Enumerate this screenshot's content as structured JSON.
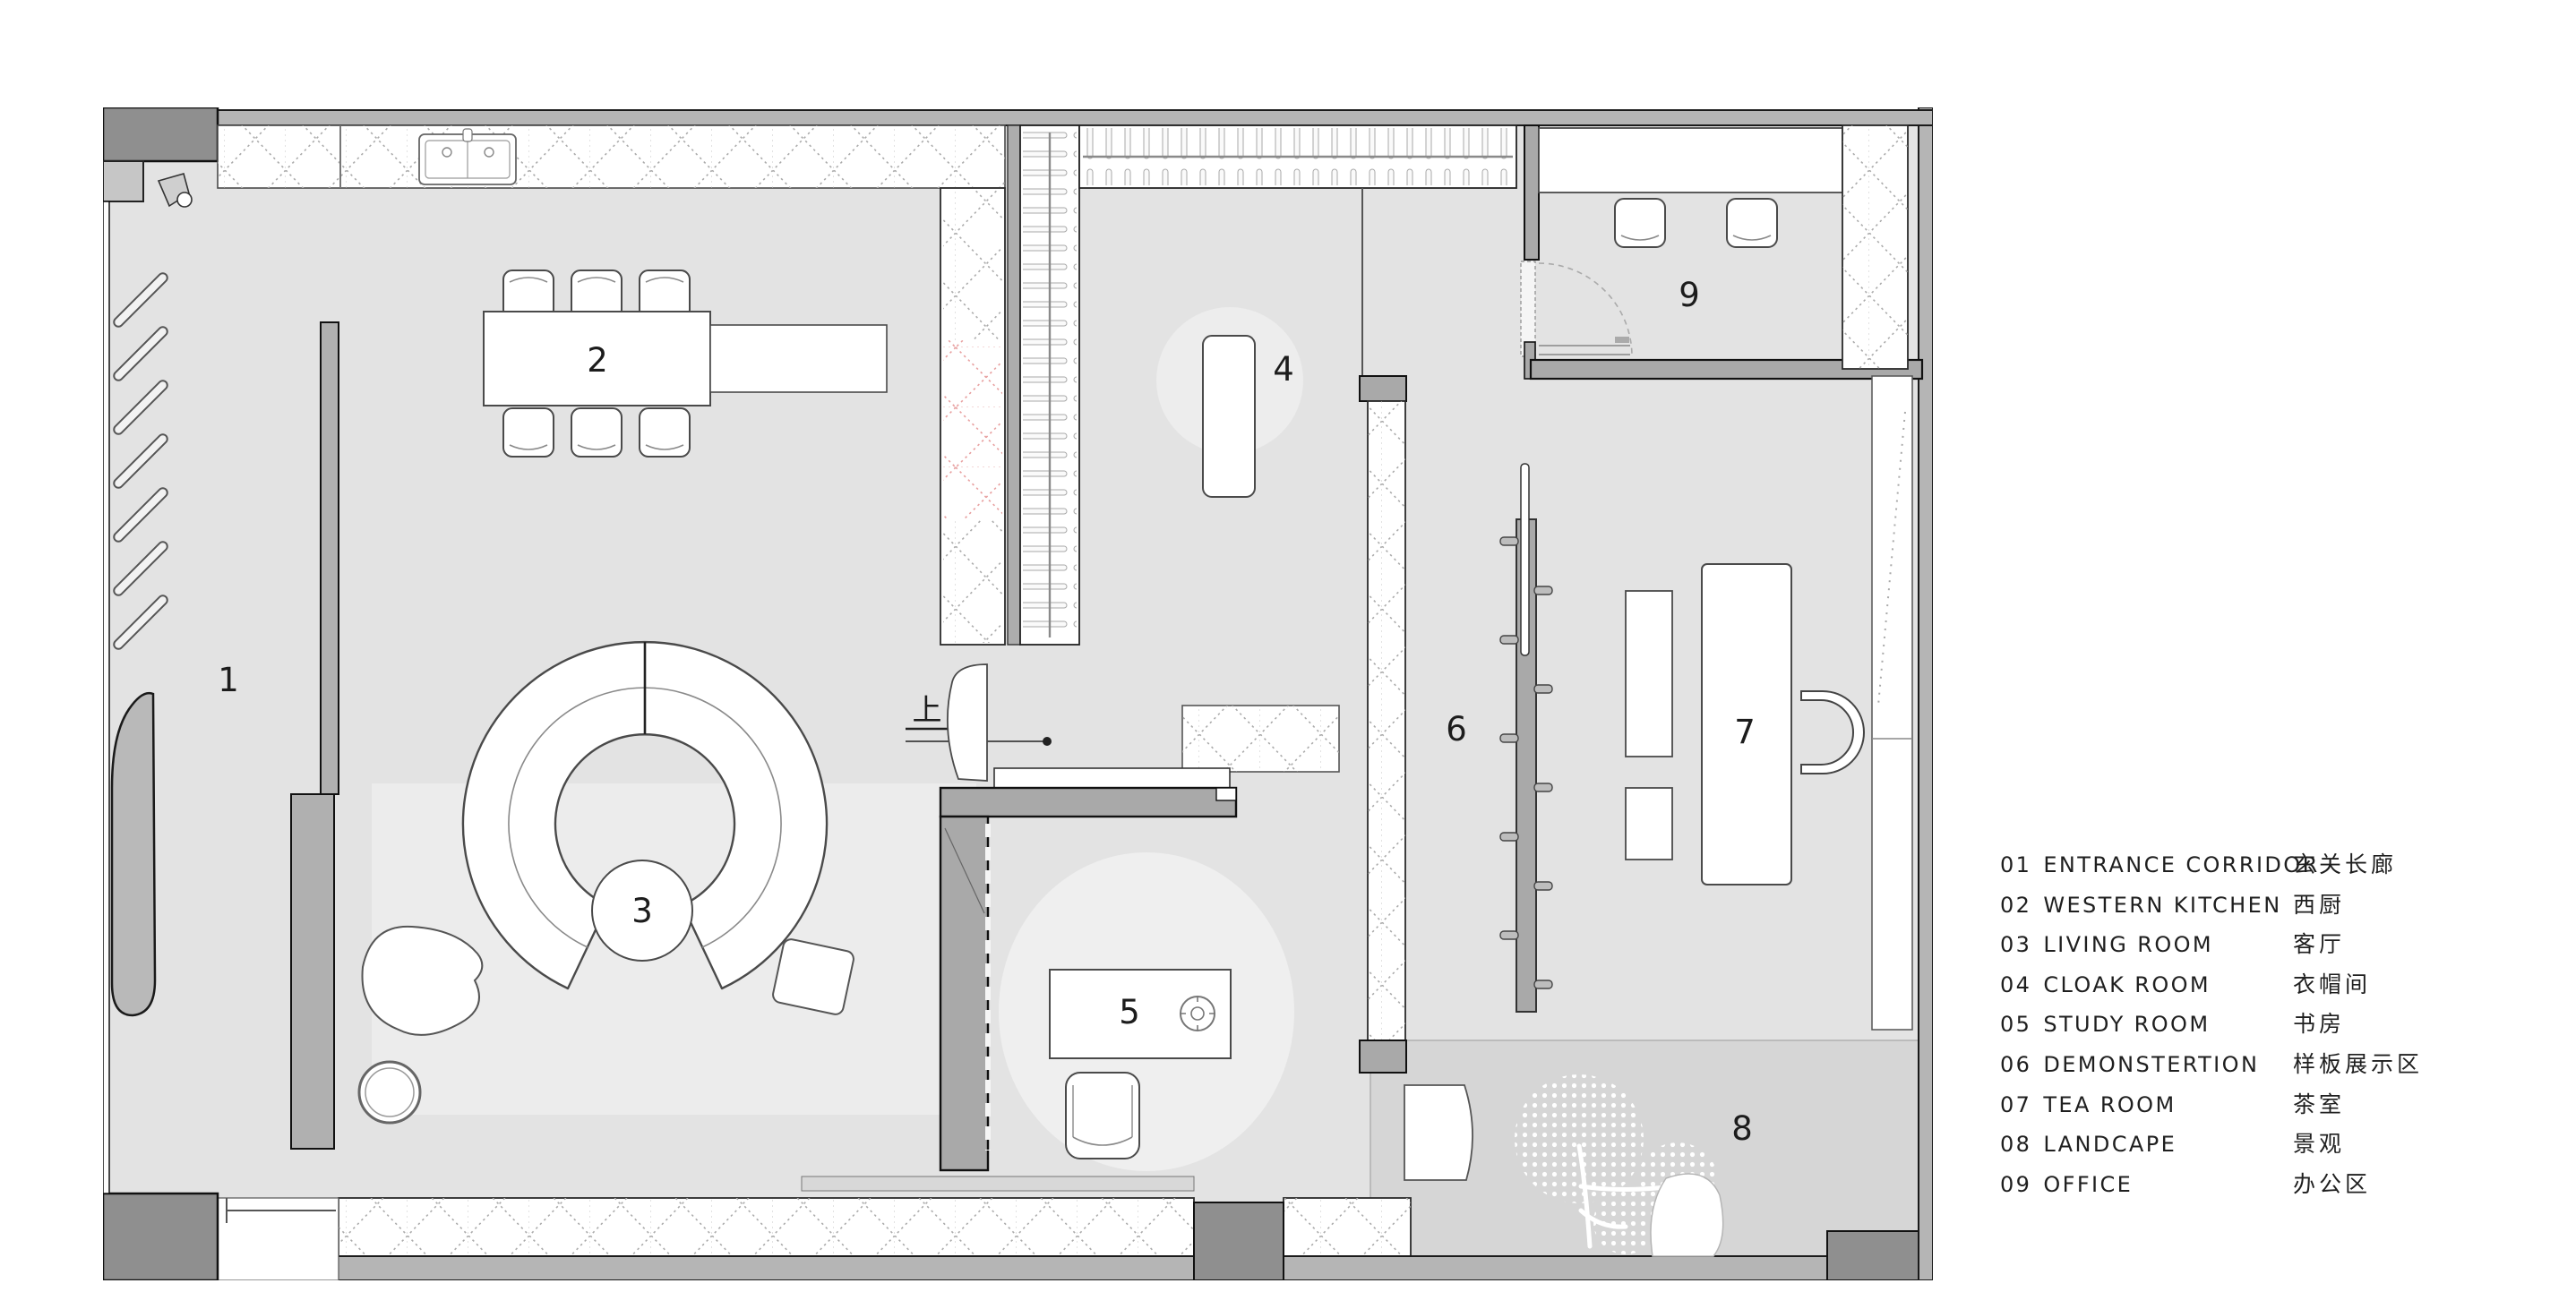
{
  "plan": {
    "rooms": [
      {
        "num": "1"
      },
      {
        "num": "2"
      },
      {
        "num": "3"
      },
      {
        "num": "4"
      },
      {
        "num": "5"
      },
      {
        "num": "6"
      },
      {
        "num": "7"
      },
      {
        "num": "8"
      },
      {
        "num": "9"
      }
    ],
    "stair_label": "上"
  },
  "legend": {
    "items": [
      {
        "num": "01",
        "en": "ENTRANCE CORRIDOR",
        "zh": "玄关长廊"
      },
      {
        "num": "02",
        "en": "WESTERN KITCHEN",
        "zh": "西厨"
      },
      {
        "num": "03",
        "en": "LIVING ROOM",
        "zh": "客厅"
      },
      {
        "num": "04",
        "en": "CLOAK ROOM",
        "zh": "衣帽间"
      },
      {
        "num": "05",
        "en": "STUDY ROOM",
        "zh": "书房"
      },
      {
        "num": "06",
        "en": "DEMONSTERTION",
        "zh": "样板展示区"
      },
      {
        "num": "07",
        "en": "TEA ROOM",
        "zh": "茶室"
      },
      {
        "num": "08",
        "en": "LANDCAPE",
        "zh": "景观"
      },
      {
        "num": "09",
        "en": "OFFICE",
        "zh": "办公区"
      }
    ]
  },
  "colors": {
    "wall": "#b5b5b5",
    "wall_dark": "#8f8f8f",
    "floor": "#e3e3e3",
    "floor_light": "#ededed",
    "landscape": "#d6d6d6",
    "hatch": "#ababab",
    "hatch_red": "#e8a0a0",
    "line": "#1a1a1a"
  }
}
